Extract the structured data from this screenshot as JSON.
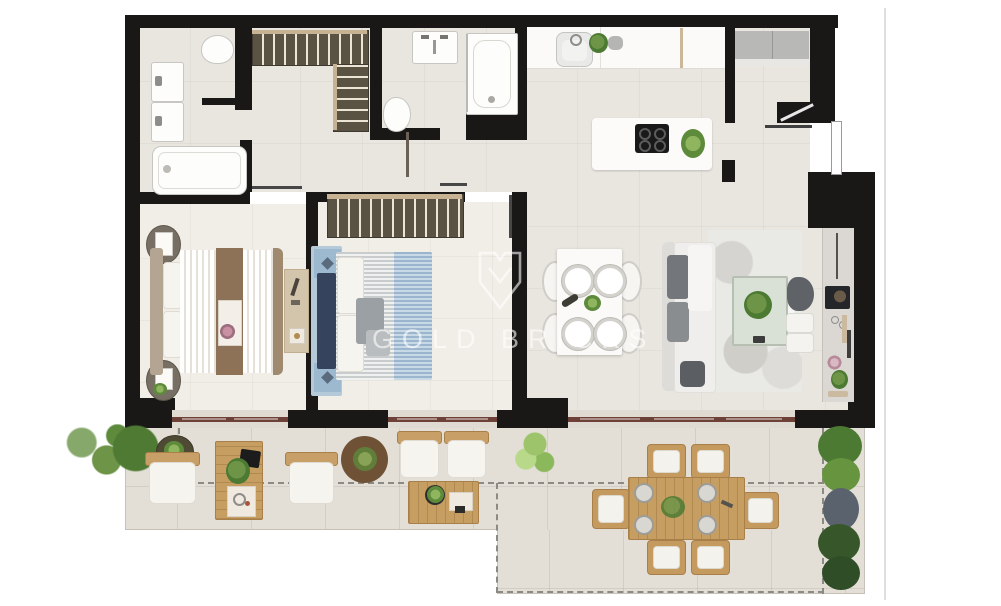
{
  "watermark": {
    "text": "GOLD BRICKS",
    "logo": "shield-logo"
  },
  "palette": {
    "wall": "#191817",
    "floor_indoor": "#e9e5df",
    "floor_bedroom": "#f1ede7",
    "floor_terrace": "#e3dfd7",
    "window_frame": "#6e4138",
    "wardrobe_wood": "#5a5243",
    "outdoor_wood": "#c49a5f",
    "bed_blue": "#a9c3da",
    "bed_brown": "#8d7258",
    "sofa_gray": "#73767a",
    "plant_green": "#4c7a33",
    "terrace_boundary_dash": "#8b8a84",
    "watermark_color": "rgba(255,255,255,0.6)"
  }
}
